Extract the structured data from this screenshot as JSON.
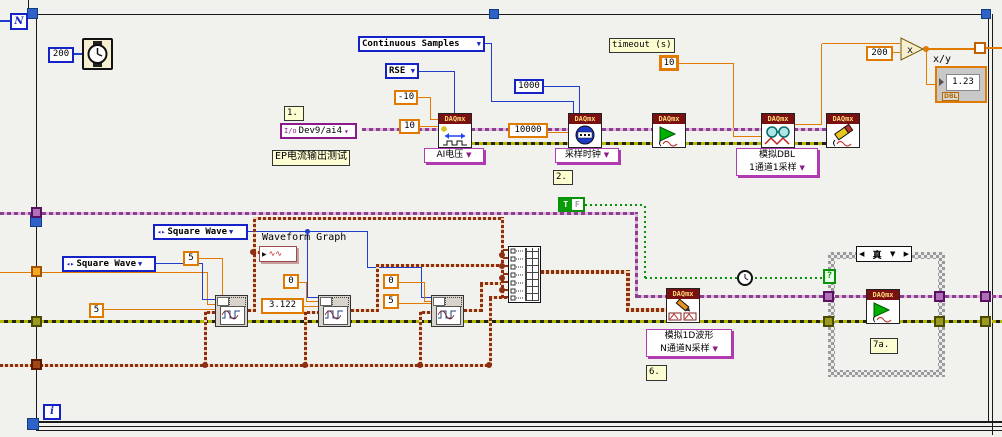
{
  "glyphs": {
    "down_arrow": "▼",
    "small_down": "▾",
    "ring_arrows": "◂▸",
    "left_nav": "◀",
    "right_nav": "▶",
    "question": "?",
    "multiply": "x",
    "io": "I/o",
    "graph_arrow": "▶",
    "wave": "∿∿"
  },
  "forloop": {
    "count": "N",
    "iteration": "i"
  },
  "daqmx_header": "DAQmx",
  "acq": {
    "wait_const": "200",
    "note_1": "1.",
    "channel_const": "Dev9/ai4",
    "test_name_label": "EP电流输出测试",
    "sample_mode_const": "Continuous Samples",
    "input_config_const": "RSE",
    "min_const": "-10",
    "max_const": "10",
    "samples_const": "1000",
    "rate_const": "10000",
    "create_channel_selector": "AI电压",
    "timing_selector": "采样时钟",
    "note_2": "2.",
    "timeout_label": "timeout (s)",
    "timeout_const": "10",
    "read_selector_line1": "模拟DBL",
    "read_selector_line2": "1通道1采样",
    "scale_const": "200",
    "xy_label": "x/y",
    "xy_value": "1.23",
    "xy_type": "DBL"
  },
  "gen": {
    "wave_type_1": "Square Wave",
    "wave_type_2": "Square Wave",
    "amp_1": "5",
    "amp_2": "5",
    "graph_label": "Waveform Graph",
    "offset_1": "0",
    "freq_1": "3.122",
    "offset_2": "0",
    "amp_3": "5",
    "true_const_t": "T",
    "true_const_f": "F",
    "write_selector_line1": "模拟1D波形",
    "write_selector_line2": "N通道N采样",
    "note_6": "6."
  },
  "case_struct": {
    "selector": "真",
    "note_7a": "7a."
  }
}
